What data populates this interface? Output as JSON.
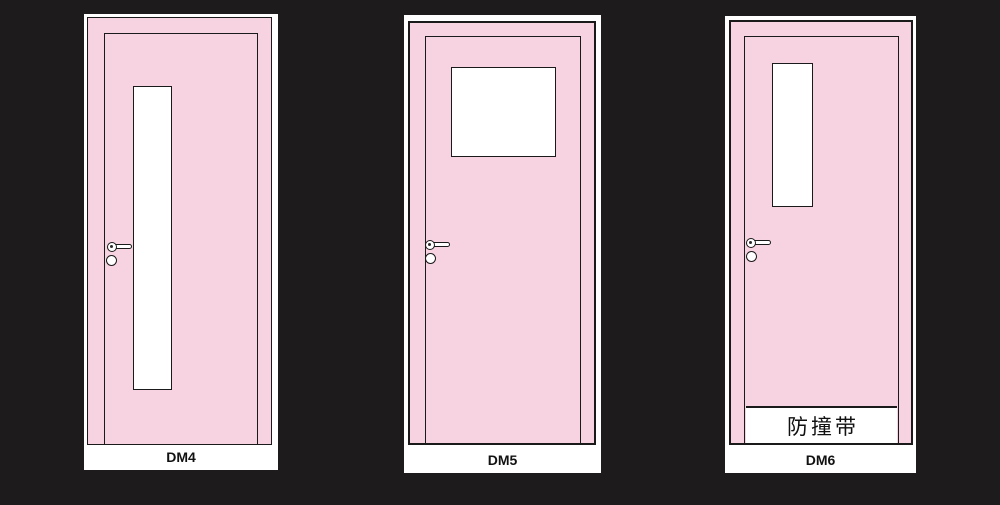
{
  "page": {
    "background_color": "#1d1b1b",
    "door_color": "#f7d3e2",
    "line_color": "#1a1a1a",
    "panel_color": "#ffffff"
  },
  "doors": [
    {
      "label": "DM4"
    },
    {
      "label": "DM5"
    },
    {
      "label": "DM6",
      "bumper_text": "防撞带"
    }
  ]
}
